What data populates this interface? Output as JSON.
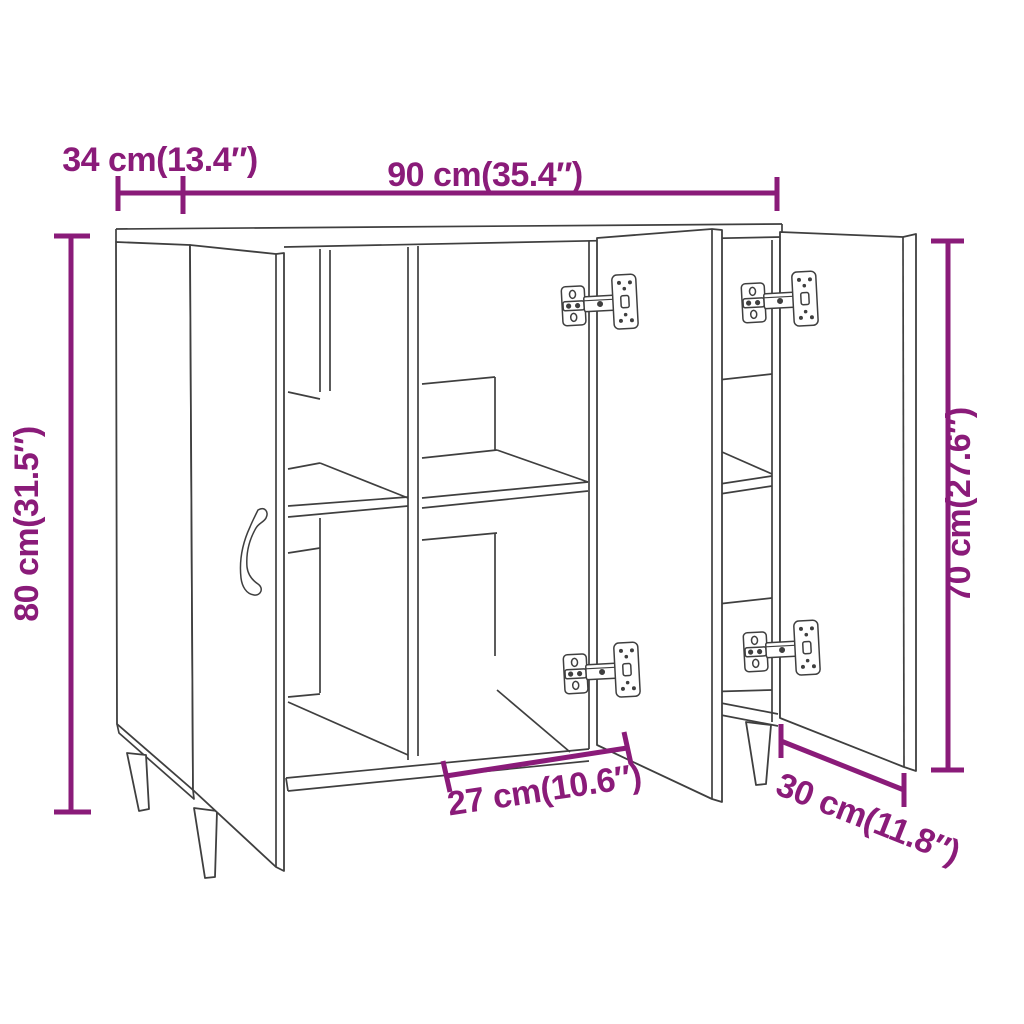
{
  "diagram": {
    "type": "furniture-dimension-diagram",
    "product": "sideboard-with-3-open-doors",
    "background_color": "#ffffff",
    "line_color": "#3f3f3f",
    "dimension_color": "#8a1b79",
    "dimensions": {
      "depth_top": {
        "label": "34 cm(13.4″)",
        "cm": 34,
        "inches": 13.4
      },
      "width_top": {
        "label": "90 cm(35.4″)",
        "cm": 90,
        "inches": 35.4
      },
      "height_left": {
        "label": "80 cm(31.5″)",
        "cm": 80,
        "inches": 31.5
      },
      "door_height_right": {
        "label": "70 cm(27.6″)",
        "cm": 70,
        "inches": 27.6
      },
      "compartment_width_bottom": {
        "label": "27 cm(10.6″)",
        "cm": 27,
        "inches": 10.6
      },
      "door_width_bottom": {
        "label": "30 cm(11.8″)",
        "cm": 30,
        "inches": 11.8
      }
    }
  }
}
